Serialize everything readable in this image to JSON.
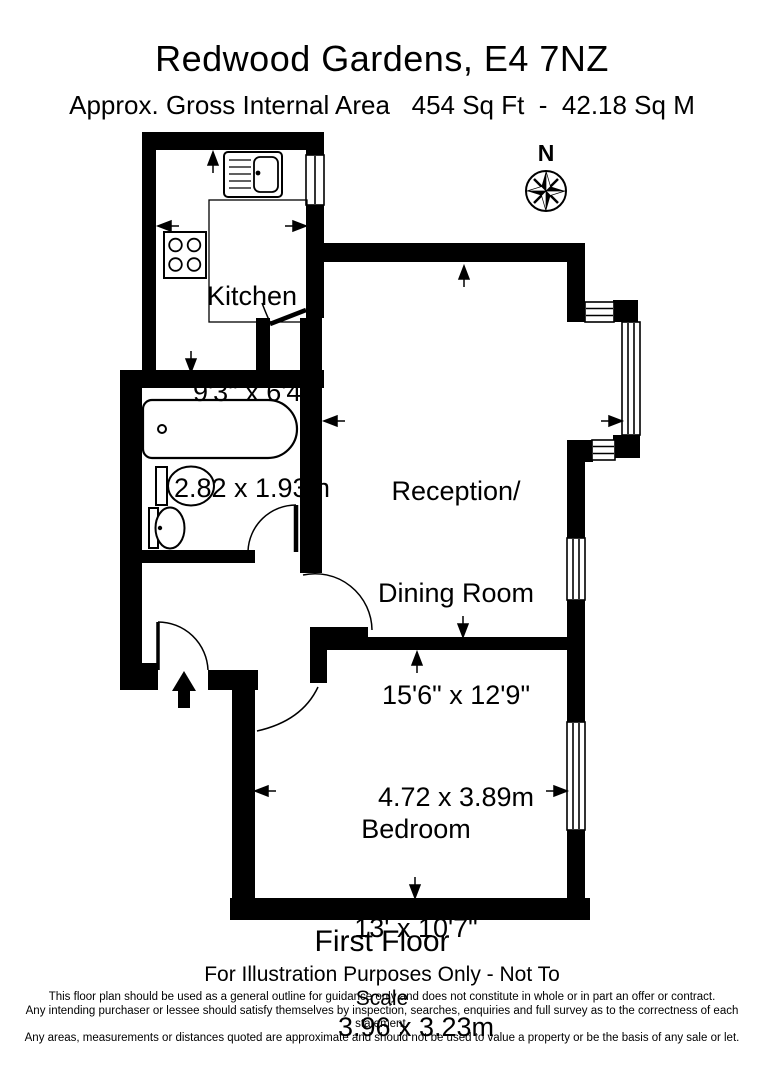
{
  "page": {
    "background": "#ffffff",
    "ink": "#000000"
  },
  "header": {
    "title": "Redwood Gardens, E4 7NZ",
    "subtitle": "Approx. Gross Internal Area   454 Sq Ft  -  42.18 Sq M"
  },
  "compass": {
    "label": "N"
  },
  "rooms": {
    "kitchen": {
      "name": "Kitchen",
      "imperial": "9'3\" x 6'4\"",
      "metric": "2.82 x 1.93m"
    },
    "reception": {
      "name_line1": "Reception/",
      "name_line2": "Dining Room",
      "imperial": "15'6\" x 12'9\"",
      "metric": "4.72 x 3.89m"
    },
    "bedroom": {
      "name": "Bedroom",
      "imperial": "13' x 10'7\"",
      "metric": "3.96 x 3.23m"
    }
  },
  "footer": {
    "floor_label": "First Floor",
    "scale_note": "For Illustration Purposes Only - Not To Scale",
    "legal": [
      "This floor plan should be used as a general outline for guidance only and does not constitute in whole or in part an offer or contract.",
      "Any intending purchaser or lessee should satisfy themselves by inspection, searches, enquiries and full survey as to the correctness of each statement.",
      "Any areas, measurements or distances quoted are approximate and should not be used to value a property or be the basis of any sale or let."
    ]
  }
}
